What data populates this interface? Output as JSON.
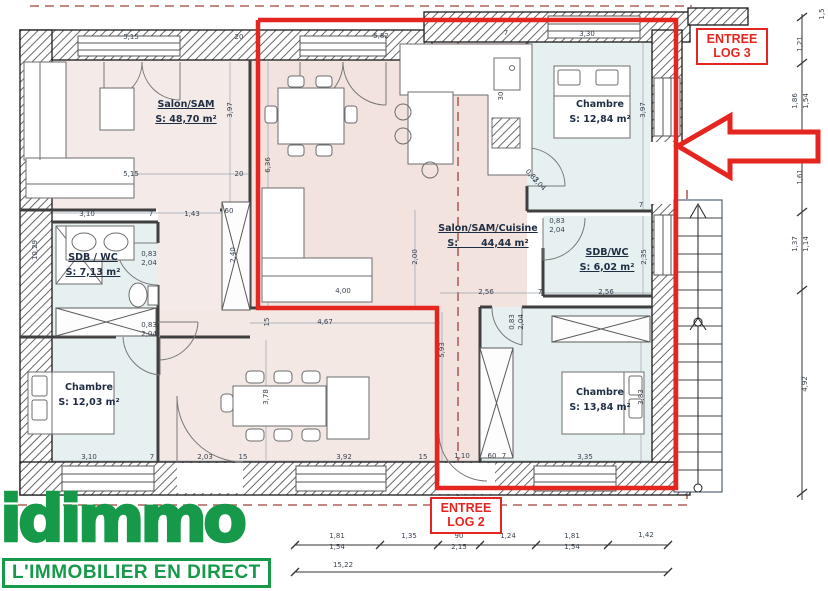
{
  "logo": {
    "name": "idimmo",
    "tagline": "L'IMMOBILIER EN DIRECT"
  },
  "annotations": {
    "entree_log3_line1": "ENTREE",
    "entree_log3_line2": "LOG 3",
    "entree_log2_line1": "ENTREE",
    "entree_log2_line2": "LOG 2"
  },
  "colors": {
    "red": "#e52620",
    "green": "#169a4a",
    "pink": "#f2e5e1",
    "blue": "#e6f0f0"
  },
  "rooms": [
    {
      "name": "Salon/SAM",
      "area": "S: 48,70 m²",
      "x": 186,
      "y": 98,
      "underline": true
    },
    {
      "name": "Salon/SAM/Cuisine",
      "area": "S:       44,44 m²",
      "x": 488,
      "y": 222,
      "underline": true
    },
    {
      "name": "Chambre",
      "area": "S: 12,84 m²",
      "x": 600,
      "y": 98,
      "underline": false
    },
    {
      "name": "SDB / WC",
      "area": "S: 7,13 m²",
      "x": 93,
      "y": 251,
      "underline": true
    },
    {
      "name": "SDB/WC",
      "area": "S: 6,02 m²",
      "x": 607,
      "y": 246,
      "underline": true
    },
    {
      "name": "Chambre",
      "area": "S: 12,03 m²",
      "x": 89,
      "y": 381,
      "underline": false
    },
    {
      "name": "Chambre",
      "area": "S: 13,84 m²",
      "x": 600,
      "y": 386,
      "underline": false
    }
  ],
  "dimensions": [
    {
      "t": "5,15",
      "x": 131,
      "y": 37,
      "r": 0
    },
    {
      "t": "20",
      "x": 239,
      "y": 37,
      "r": 0
    },
    {
      "t": "5,82",
      "x": 381,
      "y": 36,
      "r": 0
    },
    {
      "t": "7",
      "x": 506,
      "y": 33,
      "r": 0
    },
    {
      "t": "3,30",
      "x": 587,
      "y": 34,
      "r": 0
    },
    {
      "t": "5,15",
      "x": 131,
      "y": 174,
      "r": 0
    },
    {
      "t": "20",
      "x": 239,
      "y": 174,
      "r": 0
    },
    {
      "t": "3,10",
      "x": 87,
      "y": 214,
      "r": 0
    },
    {
      "t": "7",
      "x": 151,
      "y": 214,
      "r": 0
    },
    {
      "t": "1,43",
      "x": 192,
      "y": 214,
      "r": 0
    },
    {
      "t": "60",
      "x": 229,
      "y": 211,
      "r": 0
    },
    {
      "t": "0,83",
      "x": 149,
      "y": 254,
      "r": 0
    },
    {
      "t": "2,04",
      "x": 149,
      "y": 263,
      "r": 0
    },
    {
      "t": "0,83",
      "x": 557,
      "y": 221,
      "r": 0
    },
    {
      "t": "2,04",
      "x": 557,
      "y": 230,
      "r": 0
    },
    {
      "t": "0,83",
      "x": 149,
      "y": 325,
      "r": 0
    },
    {
      "t": "2,04",
      "x": 149,
      "y": 334,
      "r": 0
    },
    {
      "t": "2,56",
      "x": 486,
      "y": 292,
      "r": 0
    },
    {
      "t": "7",
      "x": 540,
      "y": 292,
      "r": 0
    },
    {
      "t": "2,56",
      "x": 606,
      "y": 292,
      "r": 0
    },
    {
      "t": "7",
      "x": 641,
      "y": 205,
      "r": 0
    },
    {
      "t": "15",
      "x": 267,
      "y": 322,
      "r": -90
    },
    {
      "t": "4,67",
      "x": 325,
      "y": 322,
      "r": 0
    },
    {
      "t": "4,00",
      "x": 343,
      "y": 291,
      "r": 0
    },
    {
      "t": "3,10",
      "x": 89,
      "y": 457,
      "r": 0
    },
    {
      "t": "7",
      "x": 152,
      "y": 457,
      "r": 0
    },
    {
      "t": "2,03",
      "x": 205,
      "y": 457,
      "r": 0
    },
    {
      "t": "15",
      "x": 243,
      "y": 457,
      "r": 0
    },
    {
      "t": "3,92",
      "x": 344,
      "y": 457,
      "r": 0
    },
    {
      "t": "15",
      "x": 423,
      "y": 457,
      "r": 0
    },
    {
      "t": "1,10",
      "x": 462,
      "y": 456,
      "r": 0
    },
    {
      "t": "60",
      "x": 492,
      "y": 456,
      "r": 0
    },
    {
      "t": "7",
      "x": 504,
      "y": 456,
      "r": 0
    },
    {
      "t": "3,35",
      "x": 585,
      "y": 457,
      "r": 0
    },
    {
      "t": "3,97",
      "x": 230,
      "y": 110,
      "r": -90
    },
    {
      "t": "6,36",
      "x": 268,
      "y": 165,
      "r": -90
    },
    {
      "t": "3,97",
      "x": 643,
      "y": 110,
      "r": -90
    },
    {
      "t": "2,35",
      "x": 644,
      "y": 257,
      "r": -90
    },
    {
      "t": "2,40",
      "x": 233,
      "y": 255,
      "r": -90
    },
    {
      "t": "2,00",
      "x": 415,
      "y": 257,
      "r": -90
    },
    {
      "t": "5,93",
      "x": 442,
      "y": 350,
      "r": -90
    },
    {
      "t": "3,78",
      "x": 266,
      "y": 397,
      "r": -90
    },
    {
      "t": "3,83",
      "x": 641,
      "y": 397,
      "r": -90
    },
    {
      "t": "10,29",
      "x": 35,
      "y": 250,
      "r": -90
    },
    {
      "t": "30",
      "x": 501,
      "y": 96,
      "r": -90
    },
    {
      "t": "0,83",
      "x": 512,
      "y": 322,
      "r": -90
    },
    {
      "t": "2,04",
      "x": 521,
      "y": 322,
      "r": -90
    },
    {
      "t": "0,83",
      "x": 532,
      "y": 176,
      "r": 45
    },
    {
      "t": "2,04",
      "x": 539,
      "y": 184,
      "r": 45
    },
    {
      "t": "1,5",
      "x": 822,
      "y": 14,
      "r": -90
    },
    {
      "t": "1,21",
      "x": 800,
      "y": 44,
      "r": -90
    },
    {
      "t": "1,86",
      "x": 795,
      "y": 101,
      "r": -90
    },
    {
      "t": "1,54",
      "x": 806,
      "y": 101,
      "r": -90
    },
    {
      "t": "1,61",
      "x": 800,
      "y": 177,
      "r": -90
    },
    {
      "t": "1,37",
      "x": 795,
      "y": 244,
      "r": -90
    },
    {
      "t": "1,14",
      "x": 806,
      "y": 244,
      "r": -90
    },
    {
      "t": "4,92",
      "x": 805,
      "y": 384,
      "r": -90
    },
    {
      "t": "1,81",
      "x": 337,
      "y": 536,
      "r": 0
    },
    {
      "t": "1,54",
      "x": 337,
      "y": 547,
      "r": 0
    },
    {
      "t": "1,35",
      "x": 409,
      "y": 536,
      "r": 0
    },
    {
      "t": "90",
      "x": 459,
      "y": 536,
      "r": 0
    },
    {
      "t": "2,15",
      "x": 459,
      "y": 547,
      "r": 0
    },
    {
      "t": "1,24",
      "x": 508,
      "y": 536,
      "r": 0
    },
    {
      "t": "1,81",
      "x": 572,
      "y": 536,
      "r": 0
    },
    {
      "t": "1,54",
      "x": 572,
      "y": 547,
      "r": 0
    },
    {
      "t": "1,42",
      "x": 646,
      "y": 535,
      "r": 0
    },
    {
      "t": "15,22",
      "x": 343,
      "y": 565,
      "r": 0
    }
  ]
}
